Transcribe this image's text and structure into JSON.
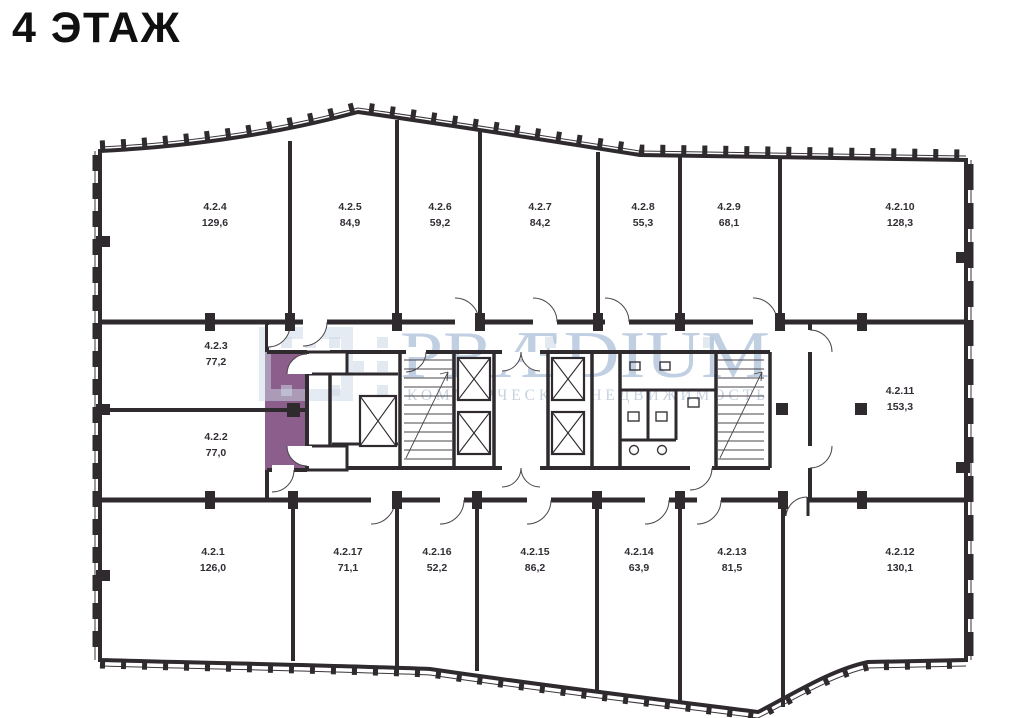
{
  "title": "4 ЭТАЖ",
  "watermark": {
    "brand": "PRÆDIUM",
    "tagline": "КОММЕРЧЕСКАЯ НЕДВИЖИМОСТЬ"
  },
  "rooms": [
    {
      "id": "4.2.1",
      "area": "126,0"
    },
    {
      "id": "4.2.2",
      "area": "77,0"
    },
    {
      "id": "4.2.3",
      "area": "77,2"
    },
    {
      "id": "4.2.4",
      "area": "129,6"
    },
    {
      "id": "4.2.5",
      "area": "84,9"
    },
    {
      "id": "4.2.6",
      "area": "59,2"
    },
    {
      "id": "4.2.7",
      "area": "84,2"
    },
    {
      "id": "4.2.8",
      "area": "55,3"
    },
    {
      "id": "4.2.9",
      "area": "68,1"
    },
    {
      "id": "4.2.10",
      "area": "128,3"
    },
    {
      "id": "4.2.11",
      "area": "153,3"
    },
    {
      "id": "4.2.12",
      "area": "130,1"
    },
    {
      "id": "4.2.13",
      "area": "81,5"
    },
    {
      "id": "4.2.14",
      "area": "63,9"
    },
    {
      "id": "4.2.15",
      "area": "86,2"
    },
    {
      "id": "4.2.16",
      "area": "52,2"
    },
    {
      "id": "4.2.17",
      "area": "71,1"
    }
  ],
  "colors": {
    "room_fill": "#8b5e8c",
    "wall": "#2e2a2e",
    "watermark": "#b3c5db",
    "background": "#ffffff"
  }
}
